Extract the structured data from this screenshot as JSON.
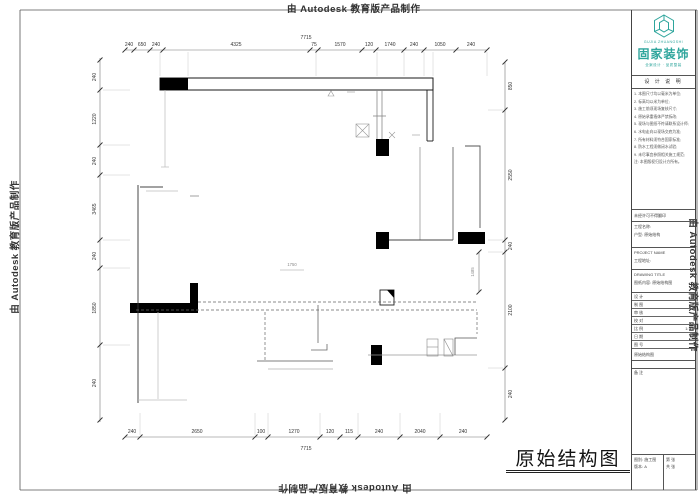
{
  "watermark": {
    "text": "由 Autodesk 教育版产品制作"
  },
  "drawing_title": {
    "text": "原始结构图"
  },
  "logo": {
    "name": "固家装饰",
    "sub_top": "GUJIA ZHUANGSHI",
    "sub_bottom": "全案设计 · 品质整装",
    "color": "#2ea59c"
  },
  "titleblock": {
    "notes_header": "设 计 说 明",
    "notes": [
      "1. 本图尺寸均以毫米为单位;",
      "2. 标高均以米为单位;",
      "3. 施工前须现场复核尺寸;",
      "4. 原始承重墙体严禁拆改;",
      "5. 现场与图纸不符请联系设计师;",
      "6. 水电走向以现场交底为准;",
      "7. 所有材料须符合国家标准;",
      "8. 防水工程须做闭水试验;",
      "9. 未尽事宜参照相关施工规范;",
      "注: 本图版权归设计方所有。"
    ],
    "row_a": "未经许可不得翻印",
    "project": {
      "line1": "工程名称:",
      "line2": "户型: 原始结构",
      "line3": ""
    },
    "block1": {
      "line1": "PROJECT NAME",
      "line2": "工程地址:"
    },
    "block2": {
      "line1": "DRAWING TITLE",
      "line2": "图纸内容: 原始结构图"
    },
    "fields": [
      {
        "label": "设 计",
        "value": ""
      },
      {
        "label": "制 图",
        "value": ""
      },
      {
        "label": "审 核",
        "value": ""
      },
      {
        "label": "校 对",
        "value": ""
      },
      {
        "label": "比 例",
        "value": "1:75"
      },
      {
        "label": "日 期",
        "value": ""
      },
      {
        "label": "图 号",
        "value": ""
      }
    ],
    "row_b": "原始结构图",
    "remark": "备 注",
    "bottom_left": {
      "line1": "图别: 施工图",
      "line2": "版本: A"
    },
    "bottom_right": {
      "line1": "第  张",
      "line2": "共  张"
    }
  },
  "dims": {
    "top_overall": "7715",
    "top": [
      "240",
      "650",
      "240",
      "4325",
      "75",
      "1570",
      "120",
      "1740",
      "240",
      "1050",
      "240"
    ],
    "bottom": [
      "240",
      "2650",
      "100",
      "1270",
      "120",
      "115",
      "240",
      "2040",
      "240"
    ],
    "bottom_overall": "7715",
    "left": [
      "240",
      "1220",
      "240",
      "3465",
      "240",
      "1850",
      "240"
    ],
    "right": [
      "850",
      "2550",
      "240",
      "2100",
      "240"
    ],
    "interior_a": "1750",
    "interior_b": "1485"
  }
}
